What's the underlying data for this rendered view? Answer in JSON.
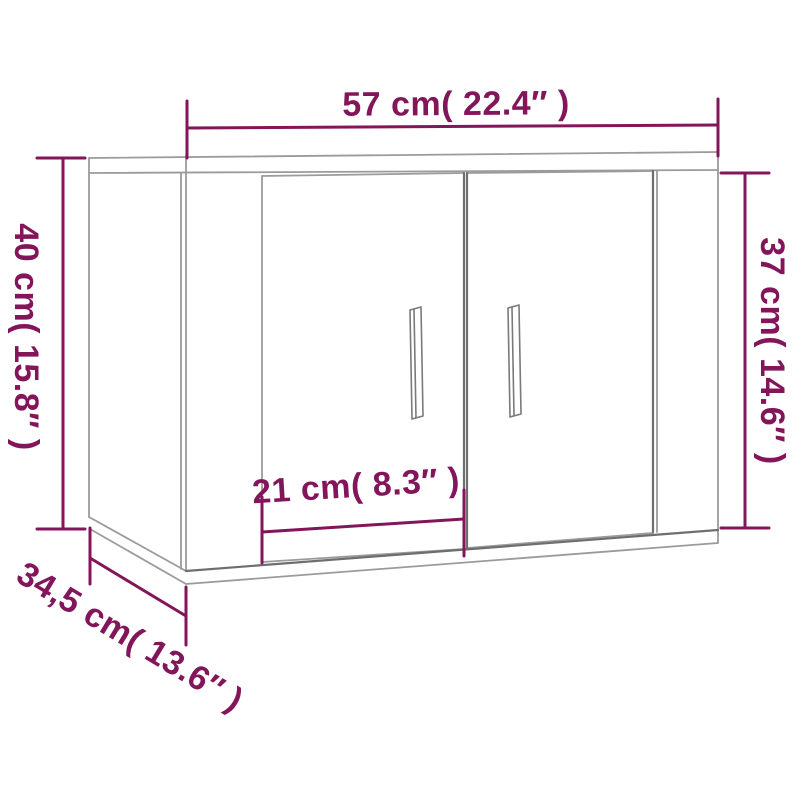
{
  "colors": {
    "background": "#FFFFFF",
    "dimension_accent": "#83155A",
    "drawing_line": "#9B9B9B",
    "drawing_line_dark": "#6E6E6E",
    "handle_line": "#7A7A7A"
  },
  "labels": {
    "width": "57 cm( 22.4″ )",
    "height_left": "40 cm( 15.8″ )",
    "height_right": "37 cm( 14.6″ )",
    "door_width": "21 cm( 8.3″ )",
    "depth": "34,5 cm( 13.6″ )"
  }
}
